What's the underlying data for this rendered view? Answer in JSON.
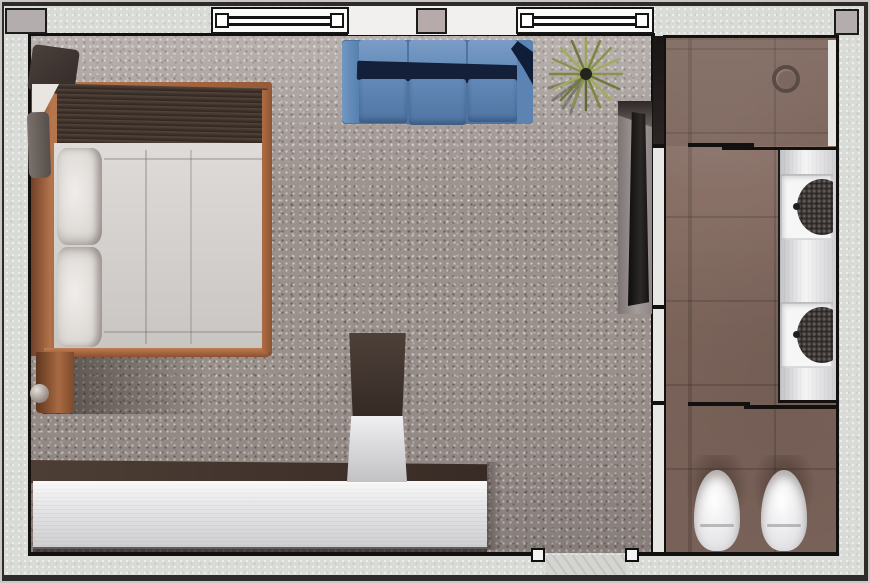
{
  "meta": {
    "kind": "3d-rendered-floor-plan",
    "view": "top-down",
    "visible_text": "none",
    "canvas": {
      "width_px": 870,
      "height_px": 583
    }
  },
  "rooms": [
    {
      "id": "bedroom",
      "floor": "gray-speckled-carpet",
      "windows": 2,
      "entry": "door-bottom-wall"
    },
    {
      "id": "bathroom",
      "floor": "brown-tile",
      "zones": [
        "shower",
        "vanity",
        "toilet-compartment"
      ]
    }
  ],
  "furniture": [
    {
      "id": "bed",
      "room": "bedroom",
      "parts": [
        "copper-wood-frame",
        "dark-brown-throw-blanket",
        "white-duvet",
        "pillow",
        "pillow",
        "corner-cushion",
        "footboard-post-with-ball-finial"
      ]
    },
    {
      "id": "sofa",
      "room": "bedroom",
      "color_name": "blue",
      "back_cushions": 3,
      "seat_cushions": 3
    },
    {
      "id": "floor-plant",
      "room": "bedroom",
      "kind": "spiky-yucca"
    },
    {
      "id": "tv-console",
      "room": "bedroom",
      "mounted_on": "partition-wall"
    },
    {
      "id": "desk-credenza",
      "room": "bedroom",
      "finish": "dark-top-white-front"
    },
    {
      "id": "desk-chair",
      "room": "bedroom",
      "parts": [
        "dark-backrest",
        "light-seat"
      ]
    },
    {
      "id": "vanity-counter",
      "room": "bathroom",
      "sinks": 2
    },
    {
      "id": "toilet",
      "room": "bathroom"
    },
    {
      "id": "bidet",
      "room": "bathroom"
    },
    {
      "id": "shower-drain",
      "room": "bathroom"
    }
  ],
  "architecture": {
    "windows": [
      {
        "id": "window-1",
        "wall": "top"
      },
      {
        "id": "window-2",
        "wall": "top"
      }
    ],
    "columns": [
      "top-left-corner",
      "top-center-between-windows",
      "top-right-corner"
    ],
    "partitions": [
      "bedroom-bathroom-wall",
      "shower-screen",
      "toilet-compartment-screen"
    ],
    "door": {
      "id": "entry-door",
      "wall": "bottom",
      "jambs": 2
    }
  },
  "palette": {
    "outer_frame": "#2f2b2a",
    "wall_stucco": "#d9dbd6",
    "carpet": "#9a908c",
    "tile": "#82695f",
    "wood_copper": "#b5764e",
    "dark_blanket": "#46382f",
    "duvet_white": "#d8d5d1",
    "sofa_blue": "#5b82b1",
    "sofa_shadow_navy": "#142039",
    "desk_top": "#453831",
    "desk_front": "#e9e9eb",
    "counter": "#ececee",
    "fixture_white": "#f4f4f5",
    "basin_dark": "#3f3937",
    "plant_green": "#8a944e"
  }
}
